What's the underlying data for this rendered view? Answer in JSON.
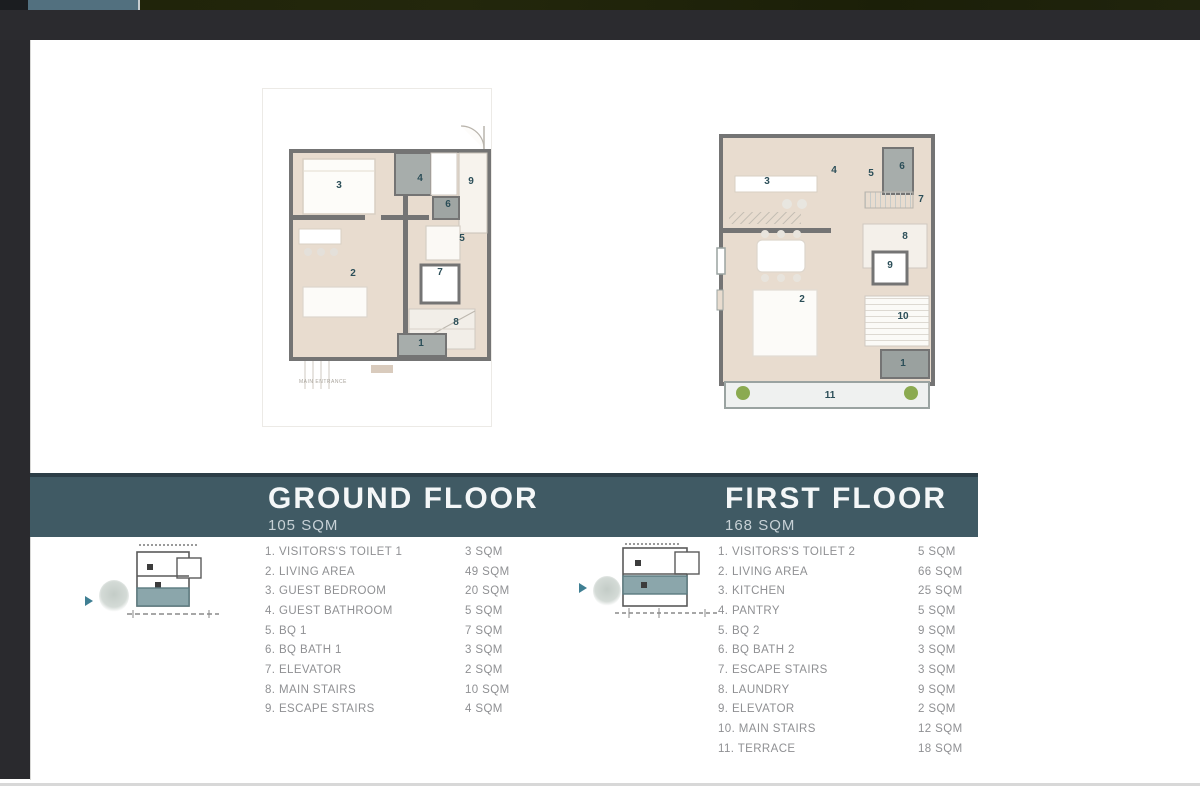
{
  "chrome": {
    "tab_color": "#52707f",
    "strip_color": "#20240a",
    "bar_color": "#2b2b2f"
  },
  "colors": {
    "banner": "#405a64",
    "accent_teal": "#3f7f93",
    "plan_floor_beige": "#e8dccf",
    "plan_wall_gray": "#747474",
    "wet_area_gray": "#a7adab",
    "plant_green": "#7fa23e",
    "list_text": "#8f9093"
  },
  "floors": {
    "ground": {
      "title": "GROUND FLOOR",
      "area": "105 SQM",
      "entrance_label": "MAIN ENTRANCE",
      "rooms": [
        {
          "label": "1. VISITORS'S TOILET 1",
          "sqm": "3 SQM"
        },
        {
          "label": "2. LIVING AREA",
          "sqm": "49 SQM"
        },
        {
          "label": "3. GUEST BEDROOM",
          "sqm": "20 SQM"
        },
        {
          "label": "4. GUEST BATHROOM",
          "sqm": "5 SQM"
        },
        {
          "label": "5. BQ 1",
          "sqm": "7 SQM"
        },
        {
          "label": "6. BQ BATH 1",
          "sqm": "3 SQM"
        },
        {
          "label": "7. ELEVATOR",
          "sqm": "2 SQM"
        },
        {
          "label": "8. MAIN STAIRS",
          "sqm": "10 SQM"
        },
        {
          "label": "9. ESCAPE STAIRS",
          "sqm": "4 SQM"
        }
      ]
    },
    "first": {
      "title": "FIRST FLOOR",
      "area": "168 SQM",
      "rooms": [
        {
          "label": "1. VISITORS'S TOILET 2",
          "sqm": "5 SQM"
        },
        {
          "label": "2. LIVING AREA",
          "sqm": "66 SQM"
        },
        {
          "label": "3. KITCHEN",
          "sqm": "25 SQM"
        },
        {
          "label": "4. PANTRY",
          "sqm": "5 SQM"
        },
        {
          "label": "5. BQ 2",
          "sqm": "9 SQM"
        },
        {
          "label": "6. BQ BATH 2",
          "sqm": "3 SQM"
        },
        {
          "label": "7. ESCAPE STAIRS",
          "sqm": "3 SQM"
        },
        {
          "label": "8. LAUNDRY",
          "sqm": "9 SQM"
        },
        {
          "label": "9. ELEVATOR",
          "sqm": "2 SQM"
        },
        {
          "label": "10. MAIN STAIRS",
          "sqm": "12 SQM"
        },
        {
          "label": "11. TERRACE",
          "sqm": "18 SQM"
        }
      ]
    }
  },
  "plans": {
    "ground": {
      "numbers": [
        "1",
        "2",
        "3",
        "4",
        "5",
        "6",
        "7",
        "8",
        "9"
      ]
    },
    "first": {
      "numbers": [
        "1",
        "2",
        "3",
        "4",
        "5",
        "6",
        "7",
        "8",
        "9",
        "10",
        "11"
      ]
    }
  }
}
